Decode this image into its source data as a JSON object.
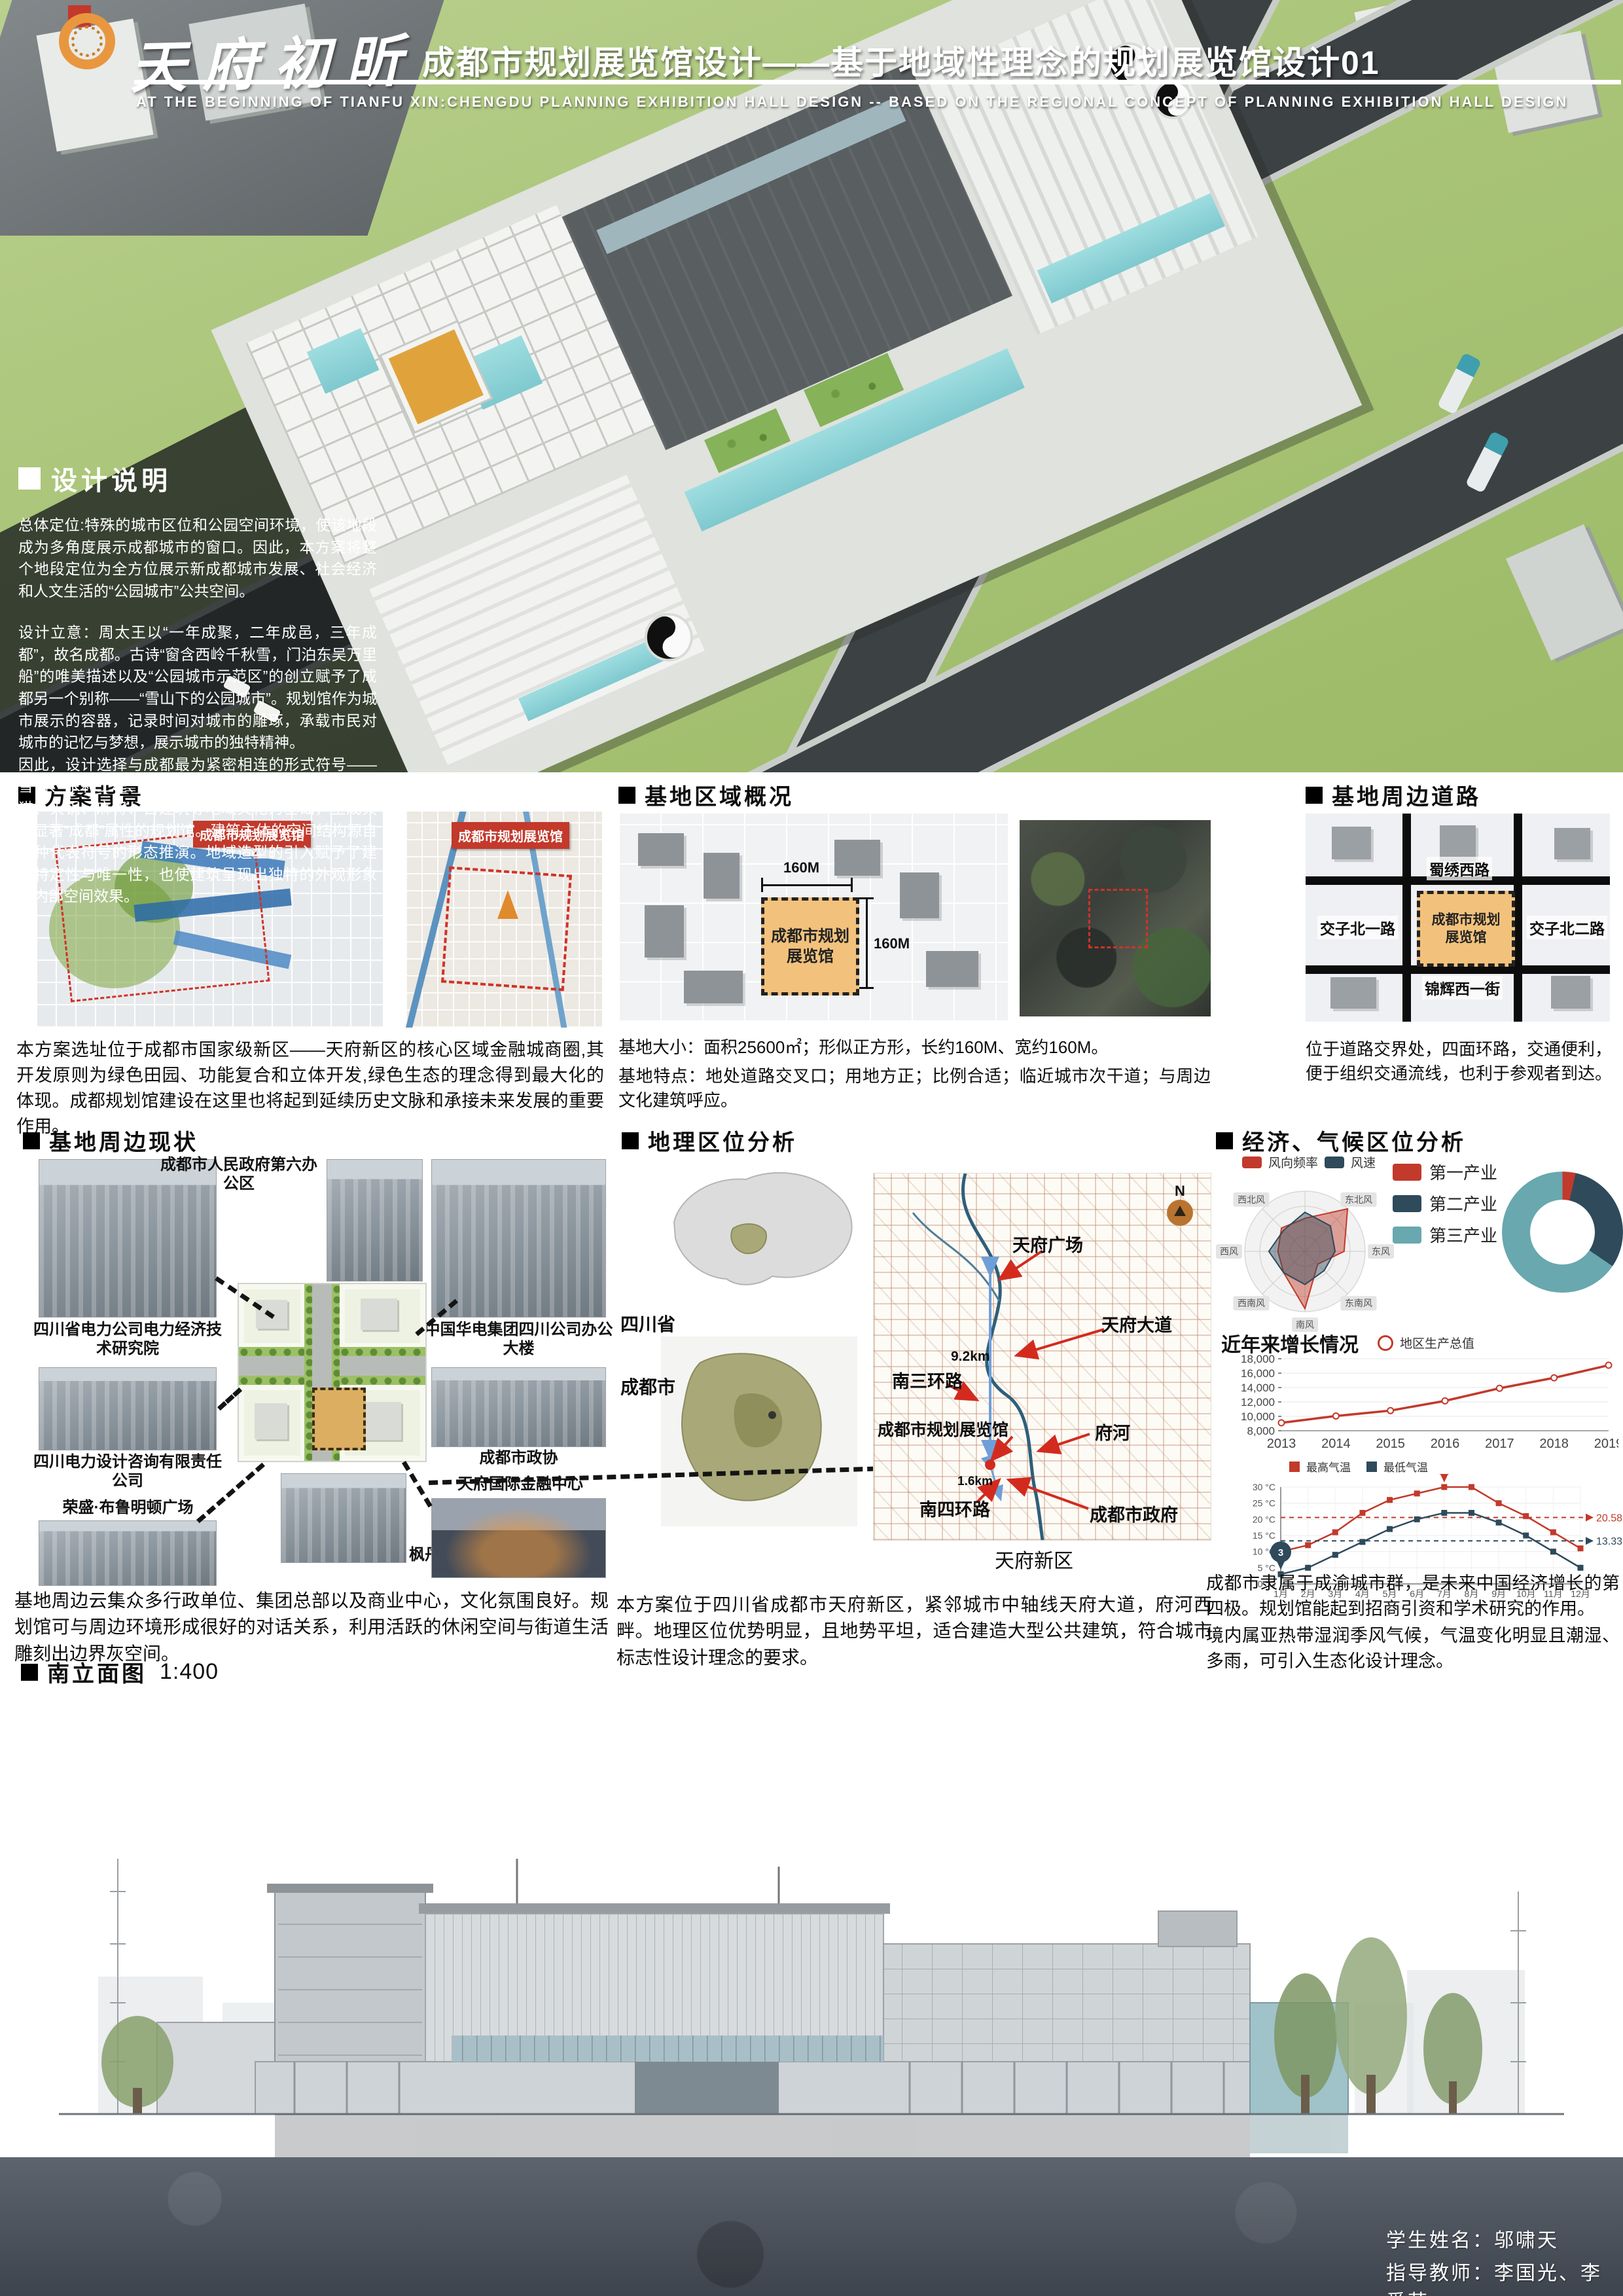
{
  "header": {
    "logo_text": "天府初昕",
    "title": "成都市规划展览馆设计——基于地域性理念的规划展览馆设计01",
    "subtitle_en": "AT THE BEGINNING OF TIANFU XIN:CHENGDU PLANNING EXHIBITION HALL DESIGN -- BASED ON THE REGIONAL CONCEPT OF PLANNING EXHIBITION HALL DESIGN"
  },
  "design_notes": {
    "heading": "设计说明",
    "p1": "总体定位:特殊的城市区位和公园空间环境，使该地段成为多角度展示成都城市的窗口。因此，本方案将整个地段定位为全方位展示新成都城市发展、社会经济和人文生活的“公园城市”公共空间。",
    "p2": "设计立意：周太王以“一年成聚，二年成邑，三年成都”，故名成都。古诗“窗含西岭千秋雪，门泊东吴万里船”的唯美描述以及“公园城市示范区”的创立赋予了成都另一个别称——“雪山下的公园城市”。规划馆作为城市展示的容器，记录时间对城市的雕琢，承载市民对城市的记忆与梦想，展示城市的独特精神。",
    "p3": "因此，设计选择与成都最为紧密相连的形式符号——雪山、水利工程、太极图、太阳神鸟、汉兴钱、大熊猫、火锅、麻将、古建筑等地域文化为基础，生成具有显著“成都”属性的规划馆。建筑主体的空间结构源自各种代表符号的形态推演。地域造型的引入赋予了建筑特定性与唯一性，也使建筑呈现出独特的外观形象和内部空间效果。"
  },
  "scheme_background": {
    "heading": "方案背景",
    "map1_badge": "成都市规划展览馆",
    "map2_badge": "成都市规划展览馆",
    "caption": "本方案选址位于成都市国家级新区——天府新区的核心区域金融城商圈,其开发原则为绿色田园、功能复合和立体开发,绿色生态的理念得到最大化的体现。成都规划馆建设在这里也将起到延续历史文脉和承接未来发展的重要作用。"
  },
  "site_overview": {
    "heading": "基地区域概况",
    "site_label_line1": "成都市规划",
    "site_label_line2": "展览馆",
    "dim_top": "160M",
    "dim_right": "160M",
    "caption1": "基地大小：面积25600㎡；形似正方形，长约160M、宽约160M。",
    "caption2": "基地特点：地处道路交叉口；用地方正；比例合适；临近城市次干道；与周边文化建筑呼应。"
  },
  "site_roads": {
    "heading": "基地周边道路",
    "road_top": "蜀绣西路",
    "road_left": "交子北一路",
    "road_right": "交子北二路",
    "road_bottom": "锦辉西一街",
    "site_label_line1": "成都市规划",
    "site_label_line2": "展览馆",
    "caption": "位于道路交界处，四面环路，交通便利，便于组织交通流线，也利于参观者到达。"
  },
  "surroundings": {
    "heading": "基地周边现状",
    "photos": [
      "四川省电力公司电力经济技术研究院",
      "成都市人民政府第六办公区",
      "中国华电集团四川公司办公大楼",
      "四川电力设计咨询有限责任公司",
      "成都市政协",
      "荣盛·布鲁明顿广场",
      "枫丹国际",
      "天府国际金融中心"
    ],
    "caption": "基地周边云集众多行政单位、集团总部以及商业中心，文化氛围良好。规划馆可与周边环境形成很好的对话关系，利用活跃的休闲空间与街道生活雕刻出边界灰空间。"
  },
  "geo_analysis": {
    "heading": "地理区位分析",
    "province_label": "四川省",
    "city_label": "成都市",
    "compass": "N",
    "map_labels": {
      "tianfu_square": "天府广场",
      "tianfu_avenue": "天府大道",
      "ring3": "南三环路",
      "hall": "成都市规划展览馆",
      "river": "府河",
      "ring4": "南四环路",
      "gov": "成都市政府",
      "district": "天府新区"
    },
    "dist1": "9.2km",
    "dist2": "1.6km",
    "caption": "本方案位于四川省成都市天府新区，紧邻城市中轴线天府大道，府河西畔。地理区位优势明显，且地势平坦，适合建造大型公共建筑，符合城市标志性设计理念的要求。"
  },
  "econ_climate": {
    "heading": "经济、气候区位分析",
    "caption1": "成都市隶属于成渝城市群，是未来中国经济增长的第四极。规划馆能起到招商引资和学术研究的作用。",
    "caption2": "境内属亚热带湿润季风气候，气温变化明显且潮湿、多雨，可引入生态化设计理念。"
  },
  "elevation": {
    "heading": "南立面图",
    "scale": "1:400"
  },
  "credits": {
    "student": "学生姓名：邬啸天",
    "advisors": "指导教师：李国光、李爱芳"
  },
  "chart_data": [
    {
      "id": "wind_rose",
      "type": "radar",
      "legend": [
        "风向频率",
        "风速"
      ],
      "colors": [
        "#c23a2b",
        "#2e4a5b"
      ],
      "axes": [
        "",
        "东北风",
        "东风",
        "东南风",
        "南风",
        "西南风",
        "西风",
        "西北风"
      ],
      "series": [
        {
          "name": "风向频率",
          "values": [
            5.5,
            10,
            6.5,
            3,
            9.5,
            5,
            4.5,
            5.5
          ]
        },
        {
          "name": "风速",
          "values": [
            6.5,
            6,
            5,
            4.5,
            5.5,
            5,
            6,
            5
          ]
        }
      ],
      "max": 10,
      "grid": "rings-4"
    },
    {
      "id": "industry_donut",
      "type": "pie",
      "labels": [
        "第一产业",
        "第二产业",
        "第三产业"
      ],
      "values": [
        3.5,
        31,
        65.5
      ],
      "colors": [
        "#c23a2b",
        "#2e4a5b",
        "#68a8ae"
      ],
      "legend_position": "left"
    },
    {
      "id": "gdp_line",
      "type": "line",
      "title": "近年来增长情况",
      "legend": [
        "地区生产总值"
      ],
      "x": [
        2013,
        2014,
        2015,
        2016,
        2017,
        2018,
        2019
      ],
      "values": [
        9100,
        10050,
        10800,
        12150,
        13900,
        15350,
        17100
      ],
      "ylim": [
        8000,
        18000
      ],
      "ytick_step": 2000,
      "color": "#c23a2b",
      "grid": "horizontal"
    },
    {
      "id": "temp_line",
      "type": "line",
      "categories": [
        "1月",
        "2月",
        "3月",
        "4月",
        "5月",
        "6月",
        "7月",
        "8月",
        "9月",
        "10月",
        "11月",
        "12月"
      ],
      "series": [
        {
          "name": "最高气温",
          "color": "#c23a2b",
          "values": [
            10,
            12,
            16,
            22,
            26,
            28,
            30,
            30,
            25,
            21,
            16,
            11
          ],
          "avg": 20.58,
          "peak_label": "30",
          "peak_index": 6
        },
        {
          "name": "最低气温",
          "color": "#2e4a5b",
          "values": [
            3,
            5,
            9,
            13,
            17,
            20,
            22,
            22,
            19,
            15,
            10,
            5
          ],
          "avg": 13.33,
          "peak_label": "3",
          "peak_index": 0
        }
      ],
      "ylim": [
        0,
        30
      ],
      "ytick_step": 5,
      "ylabel_suffix": " °C",
      "grid": "both"
    }
  ]
}
